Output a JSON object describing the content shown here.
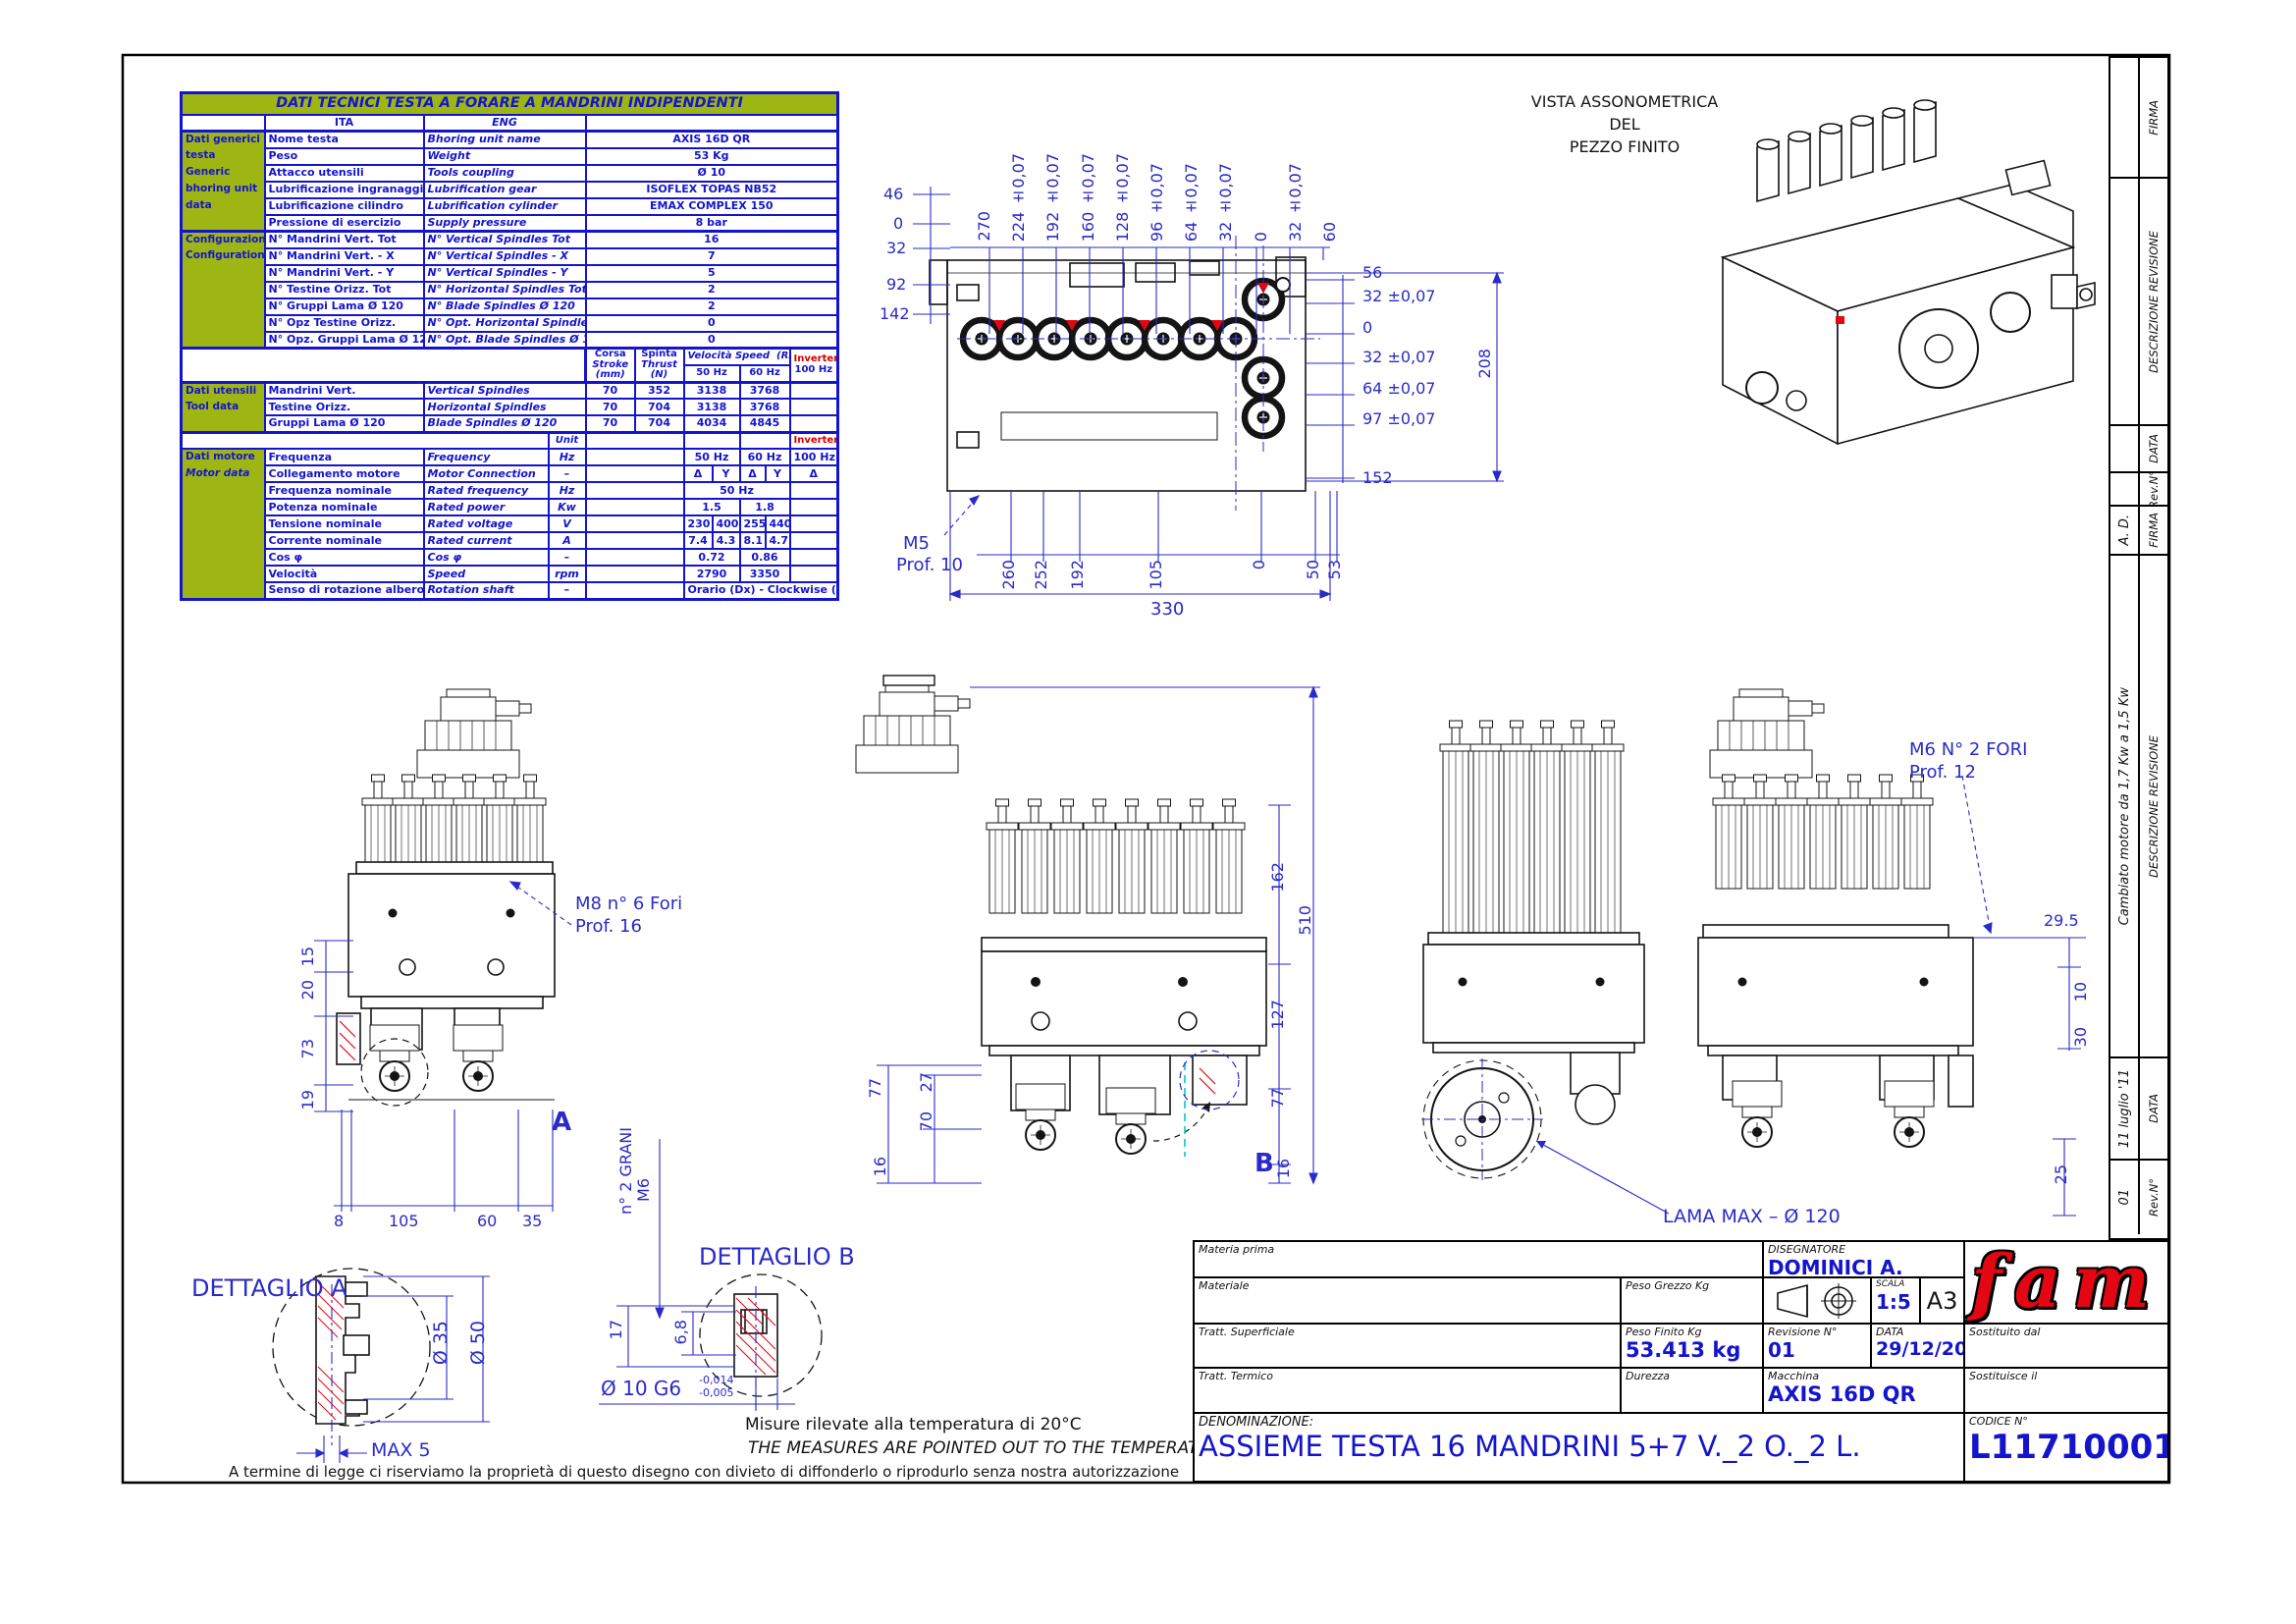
{
  "colors": {
    "table_blue": "#1414cc",
    "cad_blue": "#2a2ac8",
    "green": "#9eb614",
    "red": "#e30613",
    "cyan": "#00c8d2"
  },
  "table": {
    "title": "DATI TECNICI TESTA A FORARE A MANDRINI INDIPENDENTI",
    "col_ita": "ITA",
    "col_eng": "ENG",
    "unit_label": "Unit",
    "inverter_label": "Inverter",
    "generic": {
      "rows": [
        {
          "g": "Dati generici",
          "ita": "Nome testa",
          "eng": "Bhoring unit name",
          "val": "AXIS 16D QR"
        },
        {
          "g": "testa",
          "ita": "Peso",
          "eng": "Weight",
          "val": "53 Kg"
        },
        {
          "g": "Generic",
          "ita": "Attacco utensili",
          "eng": "Tools coupling",
          "val": "Ø 10"
        },
        {
          "g": "bhoring unit",
          "ita": "Lubrificazione ingranaggi",
          "eng": "Lubrification gear",
          "val": "ISOFLEX TOPAS NB52"
        },
        {
          "g": "data",
          "ita": "Lubrificazione cilindro",
          "eng": "Lubrification cylinder",
          "val": "EMAX COMPLEX 150"
        },
        {
          "g": "",
          "ita": "Pressione di esercizio",
          "eng": "Supply pressure",
          "val": "8 bar"
        }
      ]
    },
    "config": {
      "rows": [
        {
          "g": "Configurazione",
          "ita": "N° Mandrini Vert. Tot",
          "eng": "N° Vertical Spindles Tot",
          "val": "16"
        },
        {
          "g": "Configuration",
          "ita": "N° Mandrini Vert. - X",
          "eng": "N° Vertical Spindles - X",
          "val": "7"
        },
        {
          "g": "",
          "ita": "N° Mandrini Vert. - Y",
          "eng": "N° Vertical Spindles - Y",
          "val": "5"
        },
        {
          "g": "",
          "ita": "N° Testine Orizz. Tot",
          "eng": "N° Horizontal Spindles Tot",
          "val": "2"
        },
        {
          "g": "",
          "ita": "N° Gruppi Lama Ø 120",
          "eng": "N° Blade Spindles Ø 120",
          "val": "2"
        },
        {
          "g": "",
          "ita": "N° Opz Testine Orizz.",
          "eng": "N° Opt. Horizontal Spindles",
          "val": "0"
        },
        {
          "g": "",
          "ita": "N° Opz. Gruppi Lama Ø 120",
          "eng": "N° Opt. Blade Spindles Ø 120",
          "val": "0"
        }
      ]
    },
    "tool_header": {
      "corsa": "Corsa",
      "stroke": "Stroke",
      "mm": "(mm)",
      "spinta": "Spinta",
      "thrust": "Thrust",
      "n": "(N)",
      "speed": "Velocità Speed",
      "rpm": "(RPM)",
      "hz50": "50 Hz",
      "hz60": "60 Hz",
      "inverter": "Inverter",
      "hz100": "100 Hz"
    },
    "tool": {
      "rows": [
        {
          "g": "Dati utensili",
          "ita": "Mandrini Vert.",
          "eng": "Vertical Spindles",
          "corsa": "70",
          "spinta": "352",
          "s50": "3138",
          "s60": "3768"
        },
        {
          "g": "Tool data",
          "ita": "Testine Orizz.",
          "eng": "Horizontal Spindles",
          "corsa": "70",
          "spinta": "704",
          "s50": "3138",
          "s60": "3768"
        },
        {
          "g": "",
          "ita": "Gruppi Lama Ø 120",
          "eng": "Blade Spindles Ø 120",
          "corsa": "70",
          "spinta": "704",
          "s50": "4034",
          "s60": "4845"
        }
      ]
    },
    "motor": {
      "group_ita": "Dati motore",
      "group_eng": "Motor data",
      "rows": [
        {
          "ita": "Frequenza",
          "eng": "Frequency",
          "unit": "Hz",
          "a": "50 Hz",
          "b": "60 Hz",
          "inv": "100 Hz"
        },
        {
          "ita": "Collegamento motore",
          "eng": "Motor Connection",
          "unit": "–",
          "c1": "Δ",
          "c2": "Y",
          "c3": "Δ",
          "c4": "Y",
          "inv": "Δ"
        },
        {
          "ita": "Frequenza nominale",
          "eng": "Rated frequency",
          "unit": "Hz",
          "span": "50 Hz"
        },
        {
          "ita": "Potenza nominale",
          "eng": "Rated power",
          "unit": "Kw",
          "a": "1.5",
          "b": "1.8",
          "inv": ""
        },
        {
          "ita": "Tensione nominale",
          "eng": "Rated voltage",
          "unit": "V",
          "c1": "230",
          "c2": "400",
          "c3": "255",
          "c4": "440",
          "inv": ""
        },
        {
          "ita": "Corrente nominale",
          "eng": "Rated current",
          "unit": "A",
          "c1": "7.4",
          "c2": "4.3",
          "c3": "8.1",
          "c4": "4.7",
          "inv": ""
        },
        {
          "ita": "Cos φ",
          "eng": "Cos φ",
          "unit": "–",
          "a": "0.72",
          "b": "0.86",
          "inv": ""
        },
        {
          "ita": "Velocità",
          "eng": "Speed",
          "unit": "rpm",
          "a": "2790",
          "b": "3350",
          "inv": ""
        },
        {
          "ita": "Senso di rotazione albero",
          "eng": "Rotation shaft",
          "unit": "–",
          "span": "Orario (Dx) - Clockwise (Rh)"
        }
      ]
    }
  },
  "top_view": {
    "dims_top": [
      "270",
      "224 ±0,07",
      "192 ±0,07",
      "160 ±0,07",
      "128 ±0,07",
      "96 ±0,07",
      "64 ±0,07",
      "32 ±0,07",
      "0",
      "32 ±0,07",
      "60"
    ],
    "dims_left": [
      "46",
      "0",
      "32",
      "92",
      "142"
    ],
    "dims_right": [
      "56",
      "32 ±0,07",
      "0",
      "32 ±0,07",
      "64 ±0,07",
      "97 ±0,07"
    ],
    "dim_152": "152",
    "dim_208": "208",
    "dims_bottom": [
      "260",
      "252",
      "192",
      "105",
      "0",
      "50",
      "53"
    ],
    "dim_330": "330",
    "thread": "M5",
    "thread_depth": "Prof. 10"
  },
  "iso": {
    "line1": "VISTA ASSONOMETRICA",
    "line2": "DEL",
    "line3": "PEZZO FINITO"
  },
  "views": {
    "a": {
      "letter": "A",
      "dims_left": [
        "15",
        "20",
        "73",
        "19"
      ],
      "dims_bottom": [
        "8",
        "105",
        "60",
        "35"
      ],
      "label1": "M8   n° 6 Fori",
      "label2": "Prof. 16"
    },
    "b": {
      "letter": "B",
      "dim_77l": "77",
      "dim_27": "27",
      "dim_70": "70",
      "dim_16l": "16",
      "dim_162": "162",
      "dim_510": "510",
      "dim_127": "127",
      "dim_77r": "77",
      "dim_16r": "16"
    },
    "d": {
      "label1": "M6   N° 2 FORI",
      "label2": "Prof. 12",
      "dim_295": "29.5",
      "dim_10": "10",
      "dim_30": "30",
      "dim_25": "25"
    },
    "blade_label": "LAMA MAX –  Ø 120"
  },
  "detail_a": {
    "title": "DETTAGLIO A",
    "d35": "Ø 35",
    "d50": "Ø 50",
    "max5": "MAX 5"
  },
  "detail_b": {
    "title": "DETTAGLIO B",
    "m6": "M6",
    "grani": "n° 2 GRANI",
    "dim17": "17",
    "dim68": "6,8",
    "fit": "Ø  10  G6",
    "tol_top": "-0,014",
    "tol_bot": "-0,005"
  },
  "notes": {
    "temp_ita": "Misure rilevate alla temperatura di  20°C",
    "temp_eng": "THE MEASURES ARE POINTED OUT TO THE TEMPERATURE OF 20° C",
    "legal": "A termine di legge ci riserviamo la proprietà di questo disegno con divieto di diffonderlo o riprodurlo senza nostra autorizzazione"
  },
  "revisions": {
    "labels": {
      "firma": "FIRMA",
      "descr": "DESCRIZIONE REVISIONE",
      "data": "DATA",
      "rev": "Rev.N°"
    },
    "r1": {
      "firma": "",
      "descr": "",
      "data": "",
      "rev": ""
    },
    "r2": {
      "firma": "A. D.",
      "descr": "Cambiato motore da 1,7 Kw a 1,5 Kw",
      "data": "11 luglio '11",
      "rev": "01"
    }
  },
  "titleblock": {
    "materia_prima": "Materia prima",
    "materiale": "Materiale",
    "peso_grezzo": "Peso Grezzo Kg",
    "tratt_sup": "Tratt. Superficiale",
    "peso_finito": "Peso Finito Kg",
    "peso_finito_val": "53.413 kg",
    "tratt_term": "Tratt. Termico",
    "durezza": "Durezza",
    "denominazione_label": "DENOMINAZIONE:",
    "denominazione": "ASSIEME TESTA 16 MANDRINI 5+7 V._2 O._2 L.",
    "disegnatore_label": "DISEGNATORE",
    "disegnatore": "DOMINICI A.",
    "scala_label": "SCALA",
    "scala": "1:5",
    "formato": "A3",
    "revisione_label": "Revisione N°",
    "revisione": "01",
    "data_label": "DATA",
    "data": "29/12/2010",
    "sostituito": "Sostituito dal",
    "sostituisce": "Sostituisce il",
    "macchina_label": "Macchina",
    "macchina": "AXIS 16D QR",
    "codice_label": "CODICE N°",
    "codice": "L11710001",
    "logo": "fam"
  }
}
